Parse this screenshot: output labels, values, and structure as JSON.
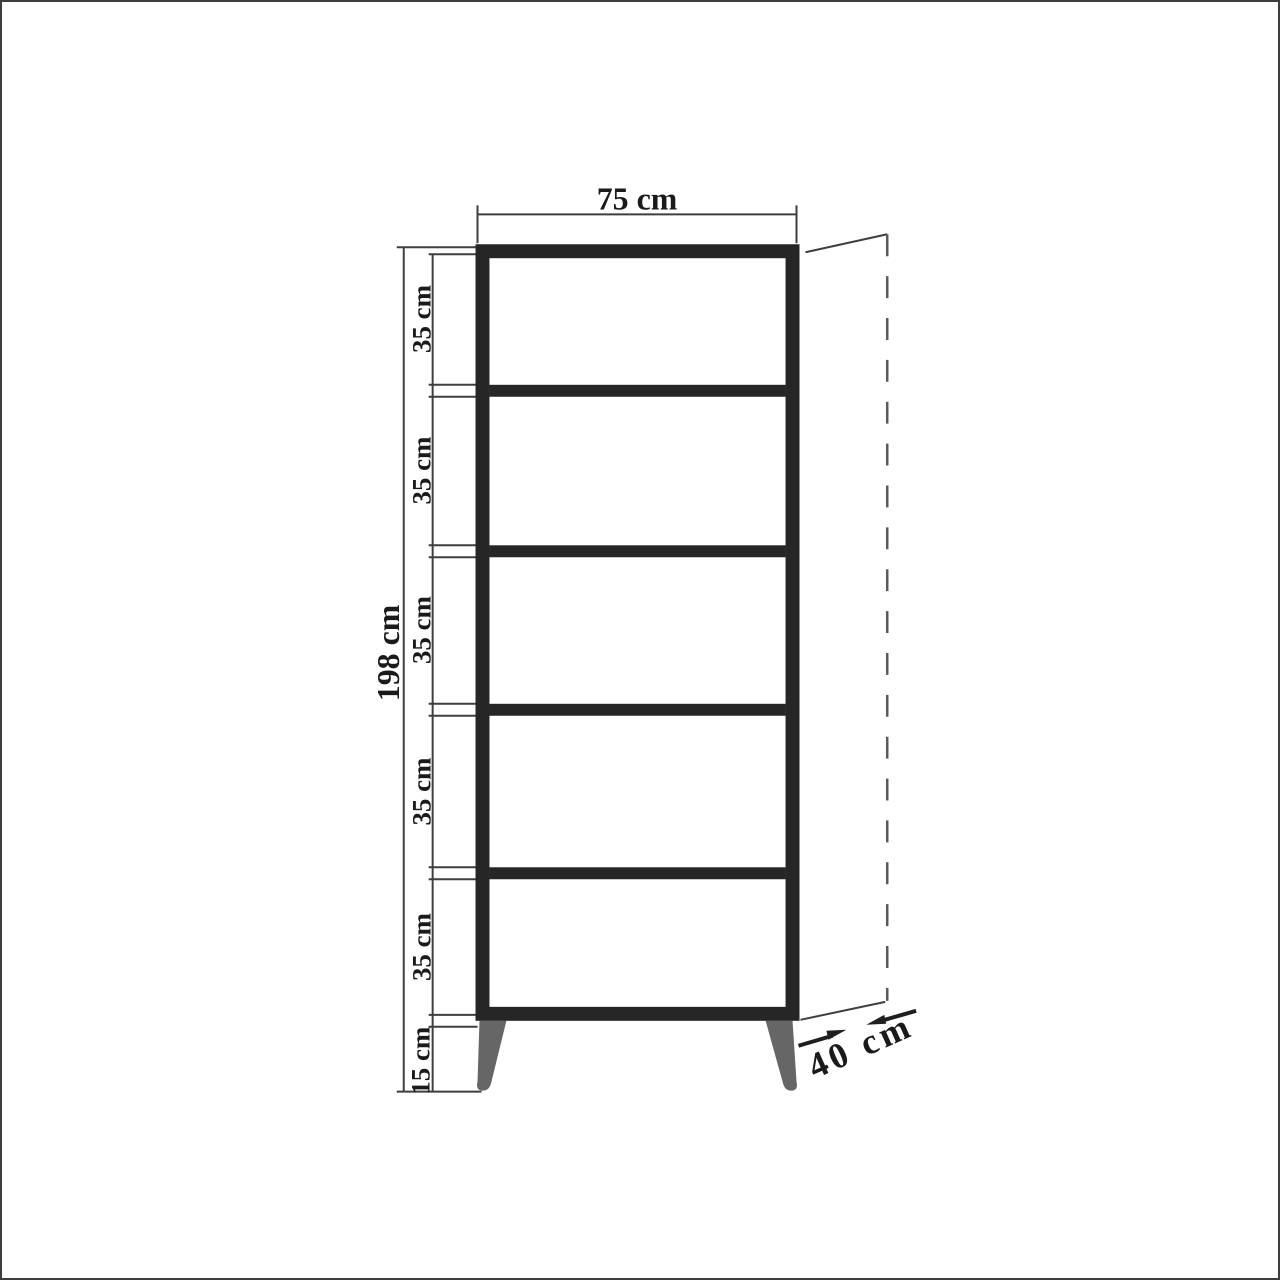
{
  "diagram": {
    "labels": {
      "width": "75 cm",
      "height": "198 cm",
      "depth": "40 cm",
      "leg_height": "15 cm",
      "shelf_gaps": [
        "35 cm",
        "35 cm",
        "35 cm",
        "35 cm",
        "35 cm"
      ]
    },
    "values_cm": {
      "width": 75,
      "height": 198,
      "depth": 40,
      "leg_height": 15,
      "shelf_gap": 35
    },
    "structure": {
      "compartments": 5,
      "shelf_dividers": 4,
      "legs": 2
    },
    "colors": {
      "cabinet_outline": "#262626",
      "dimension_lines": "#3f3f3f",
      "legs": "#666666",
      "dashed_depth_line": "#5a5a5a",
      "text": "#1a1a1a",
      "background": "#ffffff",
      "frame_border": "#3d3d3d"
    }
  }
}
